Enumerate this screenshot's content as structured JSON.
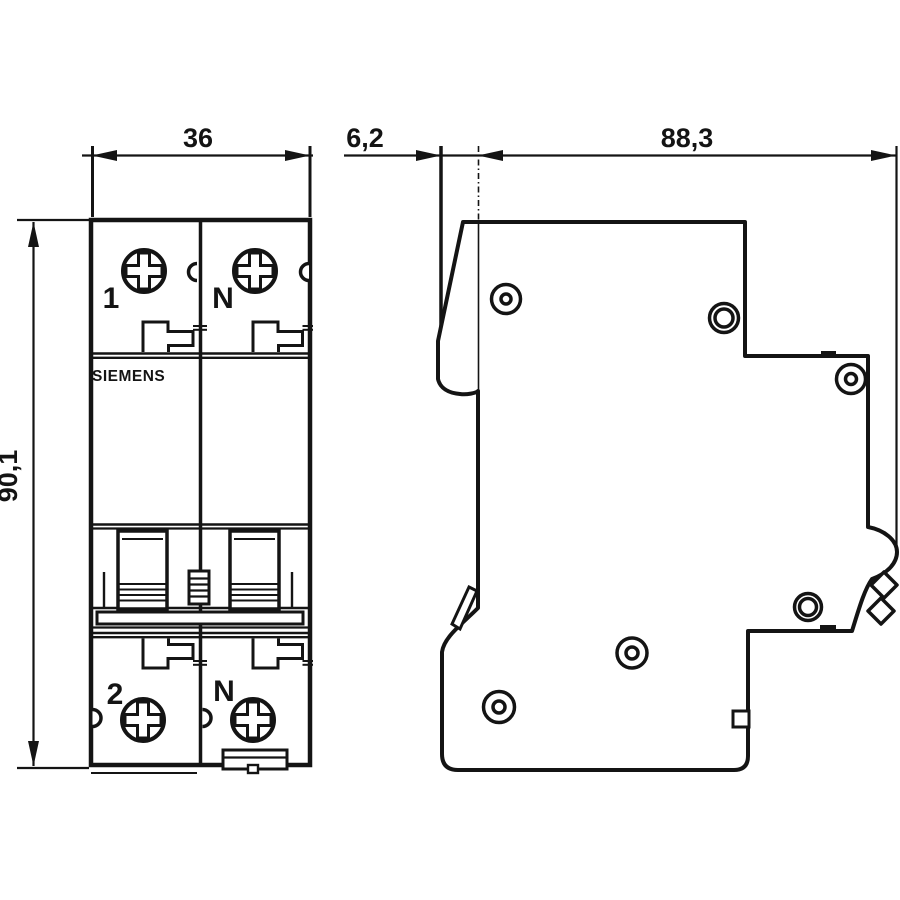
{
  "colors": {
    "ink": "#141414",
    "paper": "#ffffff"
  },
  "brand": "SIEMENS",
  "front_view": {
    "dim_width": "36",
    "dim_height": "90,1",
    "pole_top_left": "1",
    "pole_top_right": "N",
    "pole_bottom_left": "2",
    "pole_bottom_right": "N"
  },
  "side_view": {
    "dim_nose_depth": "6,2",
    "dim_total_depth": "88,3"
  }
}
